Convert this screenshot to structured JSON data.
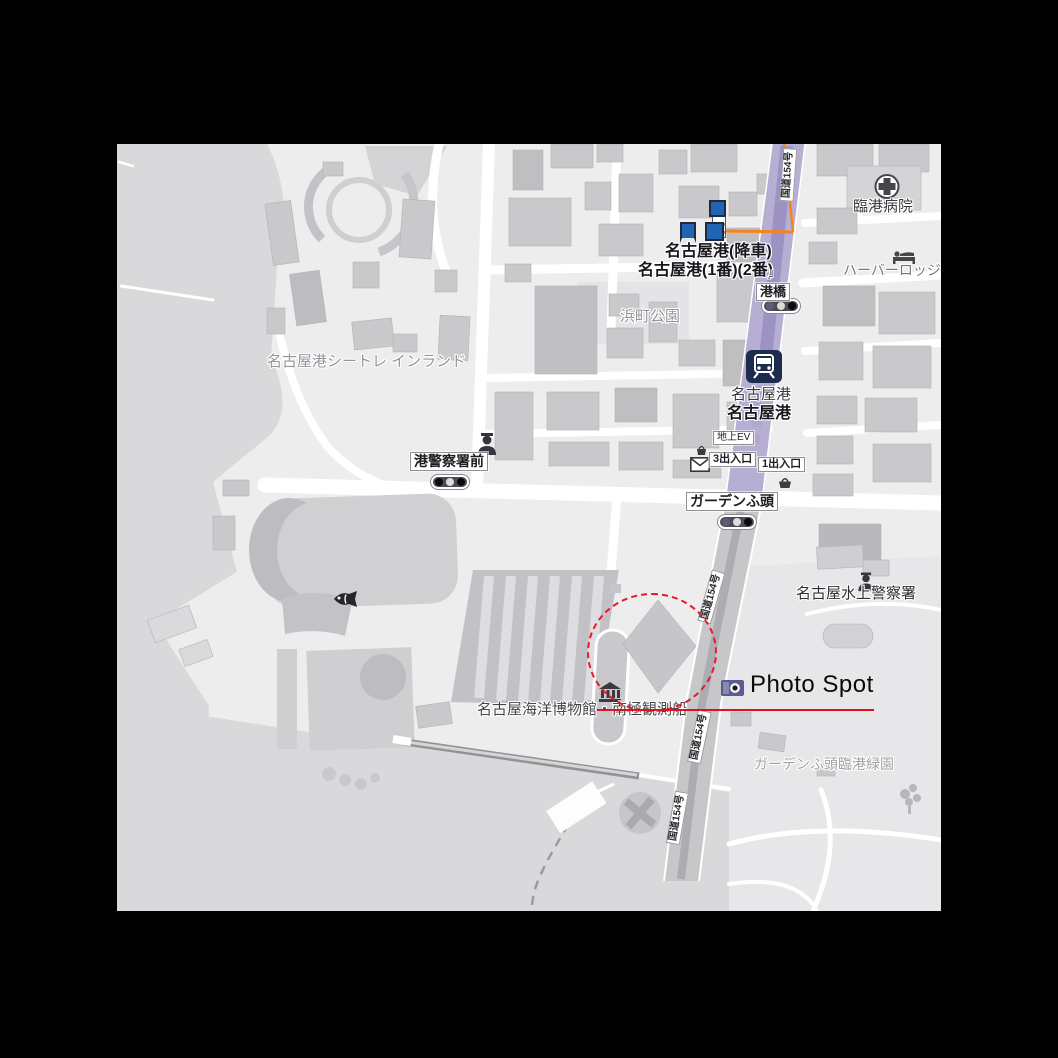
{
  "annotation": {
    "photo_spot": "Photo Spot"
  },
  "colors": {
    "annotation_red": "#e81a2a",
    "route_orange": "#f5841e",
    "bus_stop_blue": "#2064b4",
    "subway_purple": "#9d92c4",
    "road_purple": "#b7afd3",
    "station_navy": "#1e2b4c",
    "camera_purple": "#5c5c91",
    "water_gray": "#d9d9db",
    "land_gray": "#ededee"
  },
  "station": {
    "name": "名古屋港",
    "name_bold": "名古屋港",
    "ground_ev": "地上EV",
    "exit_3": "3出入口",
    "exit_1": "1出入口"
  },
  "bus": {
    "drop_off_stop": "名古屋港(降車)",
    "platform_stop": "名古屋港(1番)(2番)",
    "bracket": "」"
  },
  "places": {
    "hospital": "臨港病院",
    "lodge": "ハーバーロッジな",
    "minato_bridge": "港橋",
    "hamacho_park": "浜町公園",
    "seatrainland": "名古屋港シートレ インランド",
    "police_stop": "港警察署前",
    "garden_pier": "ガーデンふ頭",
    "water_police": "名古屋水上警察署",
    "museum": "名古屋海洋博物館・南極観測船",
    "garden_green_park": "ガーデンふ頭臨港緑園"
  },
  "roads": {
    "route154": "国道154号"
  },
  "icons": {
    "subway_station": "train-icon",
    "bus_stop": "bus-stop-square",
    "traffic_light": "three-dot-signal",
    "post_office": "envelope",
    "police": "officer",
    "hospital": "cross-in-circle",
    "hotel": "bed",
    "museum": "classical-building",
    "aquarium": "fish",
    "photo": "camera"
  }
}
